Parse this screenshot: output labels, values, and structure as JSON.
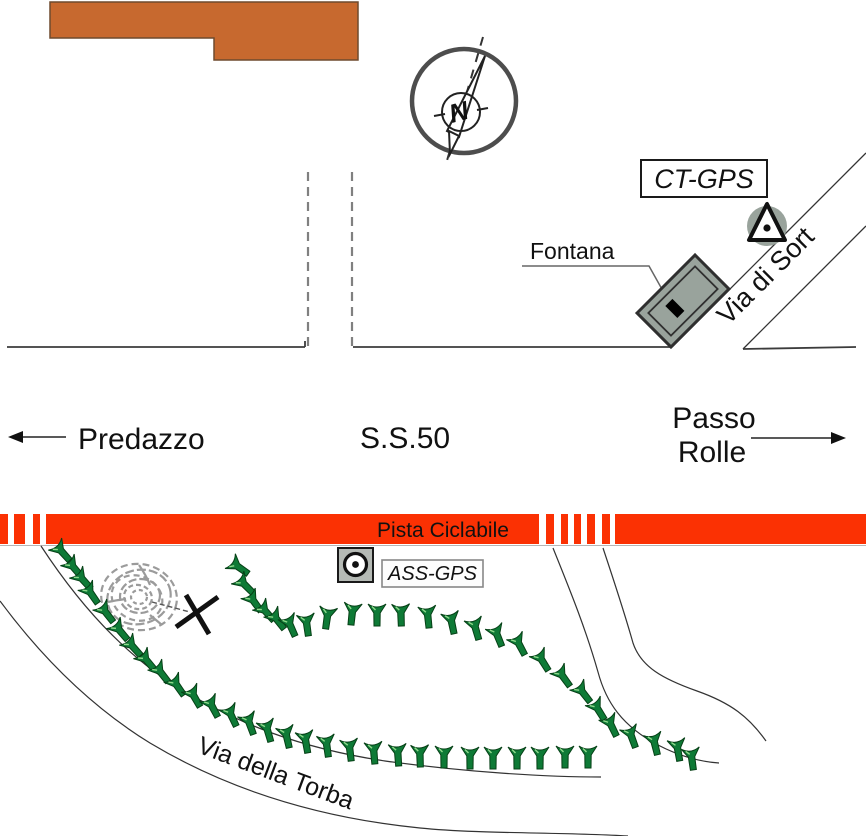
{
  "map": {
    "directions": {
      "west_label": "Predazzo",
      "road_label": "S.S.50",
      "east_label_line1": "Passo",
      "east_label_line2": "Rolle"
    },
    "labels": {
      "fountain": "Fontana",
      "ct_gps": "CT-GPS",
      "ass_gps": "ASS-GPS",
      "bike_path": "Pista Ciclabile",
      "via_di_sort": "Via di Sort",
      "via_della_torba": "Via della Torba",
      "compass_north": "N"
    },
    "colors": {
      "building": "#c7692f",
      "bike_path_red": "#fb3103",
      "tree_green": "#0e7a36",
      "marker_gray": "#99a39c"
    },
    "bike_path_band": {
      "y": 514,
      "height": 30,
      "white_gaps": [
        [
          8,
          6
        ],
        [
          25,
          8
        ],
        [
          40,
          6
        ],
        [
          539,
          7
        ],
        [
          554,
          7
        ],
        [
          568,
          6
        ],
        [
          581,
          6
        ],
        [
          595,
          7
        ],
        [
          610,
          5
        ]
      ]
    },
    "vegetation_markers": [
      [
        63,
        553,
        -42
      ],
      [
        75,
        569,
        -40
      ],
      [
        84,
        581,
        -42
      ],
      [
        92,
        595,
        -35
      ],
      [
        107,
        614,
        -38
      ],
      [
        121,
        632,
        -40
      ],
      [
        134,
        648,
        -42
      ],
      [
        148,
        662,
        -40
      ],
      [
        162,
        674,
        -38
      ],
      [
        178,
        687,
        -35
      ],
      [
        195,
        698,
        -30
      ],
      [
        213,
        708,
        -28
      ],
      [
        232,
        717,
        -25
      ],
      [
        250,
        725,
        -20
      ],
      [
        268,
        732,
        -16
      ],
      [
        287,
        738,
        -13
      ],
      [
        306,
        743,
        -10
      ],
      [
        327,
        747,
        -8
      ],
      [
        350,
        751,
        -7
      ],
      [
        374,
        754,
        -5
      ],
      [
        398,
        756,
        -4
      ],
      [
        420,
        757,
        -2
      ],
      [
        444,
        758,
        0
      ],
      [
        470,
        759,
        0
      ],
      [
        493,
        759,
        0
      ],
      [
        517,
        759,
        0
      ],
      [
        540,
        759,
        0
      ],
      [
        565,
        758,
        0
      ],
      [
        588,
        758,
        0
      ],
      [
        240,
        568,
        -55
      ],
      [
        246,
        586,
        -45
      ],
      [
        255,
        603,
        -36
      ],
      [
        267,
        613,
        -42
      ],
      [
        278,
        621,
        -38
      ],
      [
        291,
        627,
        -24
      ],
      [
        307,
        626,
        -8
      ],
      [
        327,
        619,
        8
      ],
      [
        352,
        615,
        6
      ],
      [
        377,
        616,
        0
      ],
      [
        401,
        616,
        -2
      ],
      [
        428,
        618,
        -6
      ],
      [
        452,
        624,
        -12
      ],
      [
        476,
        630,
        -16
      ],
      [
        498,
        637,
        -22
      ],
      [
        520,
        646,
        -28
      ],
      [
        543,
        662,
        -32
      ],
      [
        564,
        678,
        -36
      ],
      [
        584,
        694,
        -38
      ],
      [
        599,
        711,
        -32
      ],
      [
        612,
        727,
        -26
      ],
      [
        632,
        738,
        -20
      ],
      [
        655,
        745,
        -14
      ],
      [
        678,
        751,
        -10
      ],
      [
        692,
        760,
        -8
      ]
    ]
  }
}
